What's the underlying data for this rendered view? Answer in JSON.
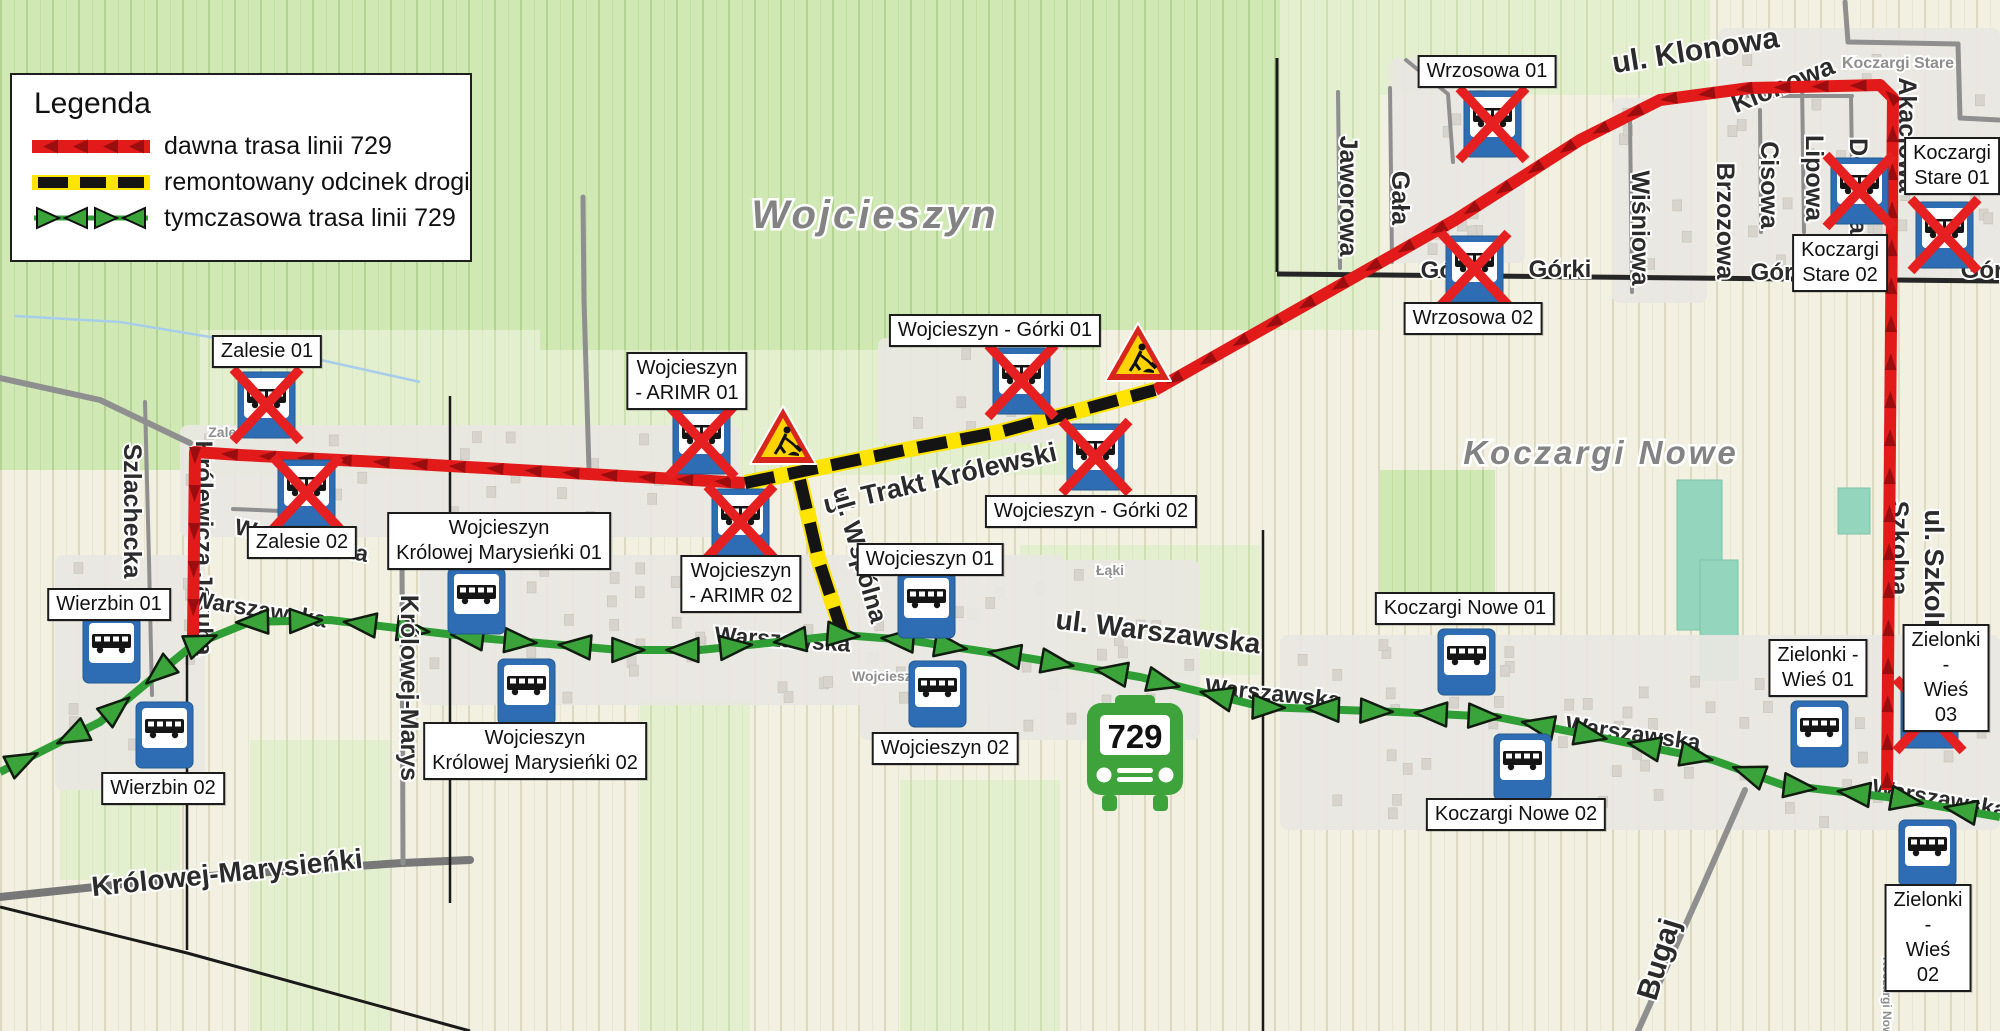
{
  "legend": {
    "title": "Legenda",
    "items": [
      {
        "id": "old-route",
        "label": "dawna trasa linii 729"
      },
      {
        "id": "renovated-section",
        "label": "remontowany odcinek drogi"
      },
      {
        "id": "temporary-route",
        "label": "tymczasowa trasa linii 729"
      }
    ]
  },
  "map": {
    "width": 2000,
    "height": 1031,
    "colors": {
      "route_old": "#e31a1a",
      "route_old_arrow": "#9c0d10",
      "route_temp": "#2f9e35",
      "route_temp_fill": "#3aa33a",
      "renovated_yellow": "#ffe400",
      "renovated_black": "#141414",
      "stop_blue": "#2e6db4",
      "cross_red": "#e62020",
      "sign_red": "#d9261c",
      "sign_yellow": "#ffd200",
      "bus_green": "#3fa33c"
    },
    "place_labels": [
      {
        "text": "Wojcieszyn",
        "x": 875,
        "y": 228,
        "size": 40
      },
      {
        "text": "Koczargi Nowe",
        "x": 1601,
        "y": 464,
        "size": 33
      }
    ],
    "minor_labels": [
      {
        "text": "Koczargi Stare",
        "x": 1898,
        "y": 68,
        "size": 16,
        "rot": 0
      },
      {
        "text": "Zalesie",
        "x": 232,
        "y": 437,
        "size": 14,
        "rot": 0
      },
      {
        "text": "Wojcieszyn",
        "x": 890,
        "y": 681,
        "size": 14,
        "rot": 0
      },
      {
        "text": "Łąki",
        "x": 1110,
        "y": 575,
        "size": 14,
        "rot": 0
      },
      {
        "text": "Koczargi Nowe",
        "x": 1883,
        "y": 1000,
        "size": 12,
        "rot": 90
      }
    ],
    "street_labels": [
      {
        "text": "ul. Klonowa",
        "x": 1697,
        "y": 60,
        "rot": -9,
        "size": 30,
        "layer": "over"
      },
      {
        "text": "ul. Trakt Królewski",
        "x": 942,
        "y": 487,
        "rot": -13,
        "size": 27,
        "layer": "over"
      },
      {
        "text": "ul. Wspólna",
        "x": 852,
        "y": 557,
        "rot": 74,
        "size": 25,
        "layer": "over"
      },
      {
        "text": "ul. Warszawska",
        "x": 1157,
        "y": 641,
        "rot": 7,
        "size": 28,
        "layer": "over"
      },
      {
        "text": "Szlachecka",
        "x": 124,
        "y": 511,
        "rot": 90,
        "size": 25,
        "layer": "over"
      },
      {
        "text": "Królowej-Marysieńki",
        "x": 228,
        "y": 882,
        "rot": -6,
        "size": 28,
        "layer": "over"
      },
      {
        "text": "Królowej-Marys",
        "x": 401,
        "y": 688,
        "rot": 90,
        "size": 25,
        "layer": "over"
      },
      {
        "text": "Jaworowa",
        "x": 1340,
        "y": 196,
        "rot": 90,
        "size": 25,
        "layer": "over"
      },
      {
        "text": "Gała",
        "x": 1392,
        "y": 198,
        "rot": 90,
        "size": 25,
        "layer": "over"
      },
      {
        "text": "Wiśniowa",
        "x": 1632,
        "y": 228,
        "rot": 90,
        "size": 25,
        "layer": "over"
      },
      {
        "text": "Brzozowa",
        "x": 1717,
        "y": 221,
        "rot": 90,
        "size": 25,
        "layer": "over"
      },
      {
        "text": "Cisowa",
        "x": 1761,
        "y": 185,
        "rot": 90,
        "size": 25,
        "layer": "over"
      },
      {
        "text": "Lipowa",
        "x": 1806,
        "y": 178,
        "rot": 90,
        "size": 25,
        "layer": "over"
      },
      {
        "text": "ul. Szkolna",
        "x": 1925,
        "y": 580,
        "rot": 90,
        "size": 27,
        "layer": "over"
      },
      {
        "text": "Górki",
        "x": 1560,
        "y": 277,
        "rot": 0,
        "size": 24,
        "layer": "over"
      },
      {
        "text": "Górki",
        "x": 1782,
        "y": 280,
        "rot": 0,
        "size": 24,
        "layer": "over"
      },
      {
        "text": "Górki",
        "x": 1992,
        "y": 278,
        "rot": 0,
        "size": 24,
        "layer": "over"
      },
      {
        "text": "Bugaj",
        "x": 1668,
        "y": 962,
        "rot": -73,
        "size": 30,
        "layer": "over"
      },
      {
        "text": "Klonowa",
        "x": 1786,
        "y": 93,
        "rot": -22,
        "size": 26,
        "layer": "under"
      },
      {
        "text": "Dębowa",
        "x": 1850,
        "y": 186,
        "rot": 90,
        "size": 25,
        "layer": "under"
      },
      {
        "text": "Akacjowa",
        "x": 1899,
        "y": 135,
        "rot": 90,
        "size": 25,
        "layer": "under"
      },
      {
        "text": "Szkolna",
        "x": 1891,
        "y": 548,
        "rot": 90,
        "size": 25,
        "layer": "under"
      },
      {
        "text": "Królewicza Jakuba",
        "x": 196,
        "y": 548,
        "rot": 90,
        "size": 24,
        "layer": "under"
      },
      {
        "text": "Warszawska",
        "x": 258,
        "y": 617,
        "rot": 9,
        "size": 23,
        "layer": "under"
      },
      {
        "text": "Warszawska",
        "x": 782,
        "y": 647,
        "rot": 4,
        "size": 23,
        "layer": "under"
      },
      {
        "text": "Warszawska",
        "x": 1272,
        "y": 701,
        "rot": 6,
        "size": 23,
        "layer": "under"
      },
      {
        "text": "Warszawska",
        "x": 1632,
        "y": 741,
        "rot": 8,
        "size": 23,
        "layer": "under"
      },
      {
        "text": "Warszawska",
        "x": 1938,
        "y": 806,
        "rot": 10,
        "size": 23,
        "layer": "under"
      },
      {
        "text": "Warszawska",
        "x": 300,
        "y": 548,
        "rot": 12,
        "size": 23,
        "layer": "under"
      },
      {
        "text": "Górki",
        "x": 1452,
        "y": 278,
        "rot": 0,
        "size": 24,
        "layer": "under"
      }
    ],
    "stops": [
      {
        "name": "Zalesie 01",
        "label_text": "Zalesie 01",
        "label": {
          "cx": 267,
          "y": 335
        },
        "icon": {
          "x": 238,
          "y": 372
        },
        "closed": true
      },
      {
        "name": "Zalesie 02",
        "label_text": "Zalesie 02",
        "label": {
          "cx": 302,
          "y": 526
        },
        "icon": {
          "x": 278,
          "y": 460
        },
        "closed": true
      },
      {
        "name": "Wierzbin 01",
        "label_text": "Wierzbin 01",
        "label": {
          "cx": 109,
          "y": 588
        },
        "icon": {
          "x": 83,
          "y": 617
        },
        "closed": false
      },
      {
        "name": "Wierzbin 02",
        "label_text": "Wierzbin 02",
        "label": {
          "cx": 163,
          "y": 772
        },
        "icon": {
          "x": 136,
          "y": 702
        },
        "closed": false
      },
      {
        "name": "Wojcieszyn Królowej Marysieńki 01",
        "label_text": "Wojcieszyn\nKrólowej Marysieńki 01",
        "label": {
          "cx": 499,
          "y": 512
        },
        "icon": {
          "x": 448,
          "y": 568
        },
        "closed": false
      },
      {
        "name": "Wojcieszyn Królowej Marysieńki 02",
        "label_text": "Wojcieszyn\nKrólowej Marysieńki 02",
        "label": {
          "cx": 535,
          "y": 722
        },
        "icon": {
          "x": 498,
          "y": 659
        },
        "closed": false
      },
      {
        "name": "Wojcieszyn - ARIMR 01",
        "label_text": "Wojcieszyn\n- ARIMR 01",
        "label": {
          "cx": 687,
          "y": 352
        },
        "icon": {
          "x": 673,
          "y": 408
        },
        "closed": true
      },
      {
        "name": "Wojcieszyn - ARIMR 02",
        "label_text": "Wojcieszyn\n- ARIMR 02",
        "label": {
          "cx": 741,
          "y": 555
        },
        "icon": {
          "x": 712,
          "y": 489
        },
        "closed": true
      },
      {
        "name": "Wojcieszyn 01",
        "label_text": "Wojcieszyn 01",
        "label": {
          "cx": 930,
          "y": 543
        },
        "icon": {
          "x": 898,
          "y": 572
        },
        "closed": false
      },
      {
        "name": "Wojcieszyn 02",
        "label_text": "Wojcieszyn 02",
        "label": {
          "cx": 945,
          "y": 732
        },
        "icon": {
          "x": 909,
          "y": 661
        },
        "closed": false
      },
      {
        "name": "Wojcieszyn - Górki 01",
        "label_text": "Wojcieszyn - Górki 01",
        "label": {
          "cx": 995,
          "y": 314
        },
        "icon": {
          "x": 993,
          "y": 348
        },
        "closed": true
      },
      {
        "name": "Wojcieszyn - Górki 02",
        "label_text": "Wojcieszyn - Górki 02",
        "label": {
          "cx": 1091,
          "y": 495
        },
        "icon": {
          "x": 1067,
          "y": 424
        },
        "closed": true
      },
      {
        "name": "Wrzosowa 01",
        "label_text": "Wrzosowa 01",
        "label": {
          "cx": 1487,
          "y": 55
        },
        "icon": {
          "x": 1464,
          "y": 91
        },
        "closed": true
      },
      {
        "name": "Wrzosowa 02",
        "label_text": "Wrzosowa 02",
        "label": {
          "cx": 1473,
          "y": 302
        },
        "icon": {
          "x": 1446,
          "y": 236
        },
        "closed": true
      },
      {
        "name": "Koczargi Stare 01",
        "label_text": "Koczargi\nStare 01",
        "label": {
          "cx": 1952,
          "y": 137
        },
        "icon": {
          "x": 1916,
          "y": 202
        },
        "closed": true
      },
      {
        "name": "Koczargi Stare 02",
        "label_text": "Koczargi\nStare 02",
        "label": {
          "cx": 1840,
          "y": 234
        },
        "icon": {
          "x": 1831,
          "y": 158
        },
        "closed": true
      },
      {
        "name": "Koczargi Nowe 01",
        "label_text": "Koczargi Nowe 01",
        "label": {
          "cx": 1465,
          "y": 592
        },
        "icon": {
          "x": 1438,
          "y": 629
        },
        "closed": false
      },
      {
        "name": "Koczargi Nowe 02",
        "label_text": "Koczargi Nowe 02",
        "label": {
          "cx": 1516,
          "y": 798
        },
        "icon": {
          "x": 1494,
          "y": 734
        },
        "closed": false
      },
      {
        "name": "Zielonki - Wieś 01",
        "label_text": "Zielonki -\nWieś 01",
        "label": {
          "cx": 1818,
          "y": 639
        },
        "icon": {
          "x": 1791,
          "y": 701
        },
        "closed": false
      },
      {
        "name": "Zielonki - Wieś 03",
        "label_text": "Zielonki -\nWieś 03",
        "label": {
          "cx": 1946,
          "y": 624
        },
        "icon": {
          "x": 1901,
          "y": 682
        },
        "closed": true
      },
      {
        "name": "Zielonki - Wieś 02",
        "label_text": "Zielonki -\nWieś 02",
        "label": {
          "cx": 1928,
          "y": 884
        },
        "icon": {
          "x": 1899,
          "y": 820
        },
        "closed": false
      }
    ],
    "routes": {
      "old": {
        "segments": [
          {
            "points": [
              [
                745,
                483
              ],
              [
                380,
                462
              ],
              [
                240,
                455
              ],
              [
                195,
                452
              ],
              [
                193,
                637
              ]
            ],
            "arrows": "forward"
          },
          {
            "points": [
              [
                1155,
                390
              ],
              [
                1300,
                308
              ],
              [
                1455,
                220
              ],
              [
                1580,
                140
              ],
              [
                1660,
                100
              ],
              [
                1750,
                88
              ],
              [
                1880,
                85
              ],
              [
                1893,
                98
              ],
              [
                1890,
                440
              ],
              [
                1887,
                790
              ]
            ],
            "arrows": "backward"
          }
        ]
      },
      "renovated": {
        "segments": [
          {
            "points": [
              [
                745,
                483
              ],
              [
                905,
                450
              ],
              [
                1000,
                432
              ],
              [
                1155,
                390
              ]
            ]
          },
          {
            "points": [
              [
                800,
                480
              ],
              [
                818,
                558
              ],
              [
                843,
                635
              ]
            ]
          }
        ]
      },
      "temporary": {
        "points": [
          [
            0,
            772
          ],
          [
            100,
            722
          ],
          [
            160,
            672
          ],
          [
            193,
            645
          ],
          [
            250,
            622
          ],
          [
            330,
            620
          ],
          [
            480,
            638
          ],
          [
            620,
            650
          ],
          [
            700,
            650
          ],
          [
            797,
            640
          ],
          [
            843,
            635
          ],
          [
            907,
            640
          ],
          [
            1027,
            658
          ],
          [
            1140,
            677
          ],
          [
            1263,
            707
          ],
          [
            1397,
            712
          ],
          [
            1497,
            717
          ],
          [
            1613,
            740
          ],
          [
            1713,
            760
          ],
          [
            1783,
            785
          ],
          [
            1887,
            797
          ],
          [
            2000,
            817
          ]
        ]
      }
    },
    "signs": {
      "roadworks": [
        {
          "x": 783,
          "y": 440
        },
        {
          "x": 1138,
          "y": 357
        }
      ],
      "bus_badge": {
        "x": 1087,
        "y": 695,
        "label": "729"
      }
    }
  }
}
